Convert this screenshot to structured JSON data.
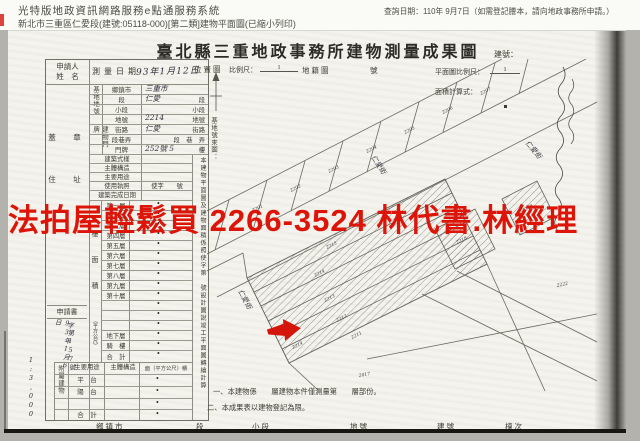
{
  "page_header": {
    "system_title": "光特版地政資訊網路服務e點通服務系統",
    "query_date": "查詢日期：110年 9月7日（如需登記謄本，請向地政事務所申請。）",
    "doc_line": "新北市三重區仁愛段(建號:05118-000)[第二類]建物平面圖(已縮小列印)"
  },
  "watermark": {
    "text": "法拍屋輕鬆買 2266-3524 林代書.林經理",
    "color": "#dd1408"
  },
  "title": {
    "main": "臺北縣三重地政事務所建物測量成果圖",
    "building_no": "建號："
  },
  "form": {
    "applicant_line1": "申請人",
    "applicant_line2": "姓　名",
    "survey_date_label": "測量日期",
    "survey_date_value": "93年1月12日",
    "seal": "蓋　章",
    "address": "住　址",
    "site_group": "基地地號",
    "site_rows": [
      {
        "label": "鄉鎮市",
        "value": "三重市",
        "suffix": ""
      },
      {
        "label": "段",
        "value": "仁愛",
        "suffix": "段"
      },
      {
        "label": "小段",
        "value": "",
        "suffix": "小段"
      },
      {
        "label": "地號",
        "value": "2214",
        "suffix": "地號"
      }
    ],
    "plate_group": "建物門牌",
    "plate_rows": [
      {
        "label": "街路",
        "value": "仁愛",
        "suffix": "街路"
      },
      {
        "label": "段巷弄",
        "value": "",
        "suffix": "段　巷　弄"
      },
      {
        "label": "門牌",
        "value": "252號 5",
        "suffix": "樓"
      }
    ],
    "building_rows": [
      {
        "label": "建築式樣",
        "value": ""
      },
      {
        "label": "主體構造",
        "value": ""
      },
      {
        "label": "主要用途",
        "value": ""
      },
      {
        "label": "使用執照",
        "value": "使字　　號"
      },
      {
        "label": "建築完成日期",
        "value": ""
      }
    ],
    "floor_area": {
      "group1": "樓　面　積",
      "group2": "（平方公尺）",
      "dot": "•",
      "rows": [
        "第一層",
        "第二層",
        "第三層",
        "第四層",
        "第五層",
        "第六層",
        "第七層",
        "第八層",
        "第九層",
        "第十層",
        "",
        "",
        "",
        "地下層",
        "騎　樓",
        "合　計"
      ]
    },
    "application": {
      "label": "申請書",
      "hw1": "93年1月6日",
      "hw2": "字第157號"
    },
    "annex": {
      "group": "附屬建物",
      "headers": [
        "主要用途",
        "主體構造",
        "面（平方公尺）積"
      ],
      "rows": [
        "平　台",
        "陽　台",
        "",
        "合　計"
      ],
      "dot": "•"
    },
    "side_note": "本建物平面圖及建物面積係照使字第　號設計圖說竣工平面圖轉繪計算",
    "scale_hw": "1:3,000"
  },
  "map": {
    "location": "位置圖",
    "scale_label": "比例尺：",
    "scale_num": "1",
    "cadastre": "地籍圖",
    "sheet_no": "號",
    "plan_scale_label": "平面圖比例尺：",
    "plan_scale_num": "1",
    "area_calc": "面積計算式：",
    "base_no_note": "基地號來圖：",
    "street": "仁愛街",
    "parcels_upper": [
      "2201",
      "2202",
      "2203",
      "2204",
      "2205",
      "2206",
      "2207"
    ],
    "parcels_lower": [
      "2215",
      "2214",
      "2213",
      "2212",
      "2211",
      "2210"
    ],
    "parcels_right": [
      "2218",
      "2219",
      "2222",
      "2017"
    ],
    "site_parcel": "2214"
  },
  "notes": {
    "n1": "一、本建物係　　層建物本件僅測量第　　層部份。",
    "n2": "二、本成果表以建物登記為限。"
  },
  "footer": {
    "cols": [
      "鄉鎮市",
      "段",
      "小段",
      "地號",
      "建號",
      "棟次"
    ]
  }
}
